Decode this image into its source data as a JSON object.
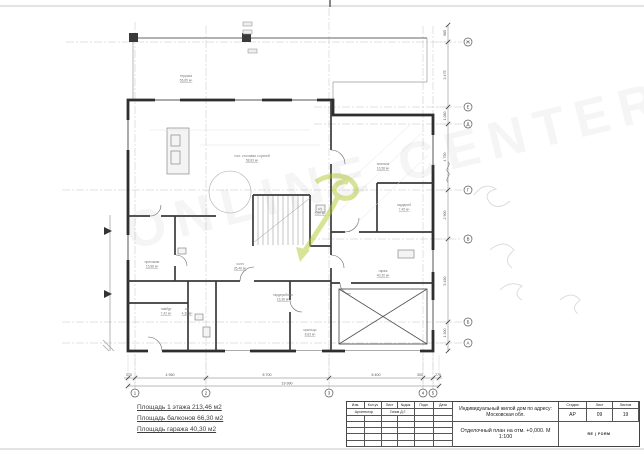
{
  "watermark": {
    "text": "ONLINE CENTER"
  },
  "areas": {
    "line1": "Площадь 1 этажа 213,46 м2",
    "line2": "Площадь балконов 66,30 м2",
    "line3": "Площадь гаража 40,30 м2"
  },
  "plan": {
    "axes_bottom": [
      {
        "label": "1",
        "x": 135
      },
      {
        "label": "2",
        "x": 206
      },
      {
        "label": "3",
        "x": 329
      },
      {
        "label": "4",
        "x": 423
      },
      {
        "label": "5",
        "x": 433
      }
    ],
    "axes_right": [
      {
        "label": "Ж",
        "y": 42
      },
      {
        "label": "Е",
        "y": 107
      },
      {
        "label": "Д",
        "y": 124
      },
      {
        "label": "Г",
        "y": 190
      },
      {
        "label": "В",
        "y": 239
      },
      {
        "label": "Б",
        "y": 322
      },
      {
        "label": "А",
        "y": 343
      }
    ],
    "dims_bottom": [
      {
        "text": "270",
        "x": 129
      },
      {
        "text": "4 950",
        "x": 170
      },
      {
        "text": "8 700",
        "x": 267
      },
      {
        "text": "8 400",
        "x": 376
      },
      {
        "text": "300",
        "x": 420
      },
      {
        "text": "270",
        "x": 438
      }
    ],
    "dim_total": {
      "text": "19 990",
      "x": 287,
      "y": 384.5
    },
    "dims_right": [
      {
        "text": "985",
        "y": 33
      },
      {
        "text": "3 475",
        "y": 75
      },
      {
        "text": "1 080",
        "y": 116
      },
      {
        "text": "4 750",
        "y": 157
      },
      {
        "text": "2 900",
        "y": 215
      },
      {
        "text": "5 450",
        "y": 281
      },
      {
        "text": "1 300",
        "y": 333
      }
    ],
    "rooms": [
      {
        "name": "терраса",
        "area": "56,85 м²",
        "x": 186,
        "y": 77
      },
      {
        "name": "гост. столовая с кухней",
        "area": "58,83 м²",
        "x": 252,
        "y": 157
      },
      {
        "name": "спальня",
        "area": "16,56 м²",
        "x": 383,
        "y": 165
      },
      {
        "name": "гардероб",
        "area": "7,45 м²",
        "x": 404,
        "y": 206
      },
      {
        "name": "холл",
        "area": "35,46 м²",
        "x": 240,
        "y": 265
      },
      {
        "name": "прихожая",
        "area": "15,88 м²",
        "x": 152,
        "y": 263
      },
      {
        "name": "тамбур",
        "area": "7,42 м²",
        "x": 166,
        "y": 310
      },
      {
        "name": "с/у",
        "area": "4,38 м²",
        "x": 187,
        "y": 310
      },
      {
        "name": "с/у",
        "area": "5,60 м²",
        "x": 320,
        "y": 210
      },
      {
        "name": "гардеробная",
        "area": "16,36 м²",
        "x": 283,
        "y": 296
      },
      {
        "name": "крыльцо",
        "area": "8,83 м²",
        "x": 310,
        "y": 331
      },
      {
        "name": "гараж",
        "area": "40,30 м²",
        "x": 383,
        "y": 272
      }
    ],
    "colors": {
      "swirl": "#b5c92f",
      "line": "#2e2e2e"
    }
  },
  "titleblock": {
    "h_izm": "Изм.",
    "h_koluch": "Кол.уч",
    "h_list": "Лист",
    "h_ndok": "№док.",
    "h_podp": "Подп.",
    "h_data": "Дата",
    "role": "Архитектор",
    "author": "Гипов Д.Г.",
    "project": "Индивидуальный жилой дом по адресу: Московская обл.",
    "sheet_title": "Отделочный план на отм. +0,000. М 1:100",
    "h_stage": "Стадия",
    "h_sheet": "Лист",
    "h_sheets": "Листов",
    "stage": "АР",
    "sheet_no": "09",
    "sheets_total": "19",
    "logo": "RE | FORM"
  }
}
